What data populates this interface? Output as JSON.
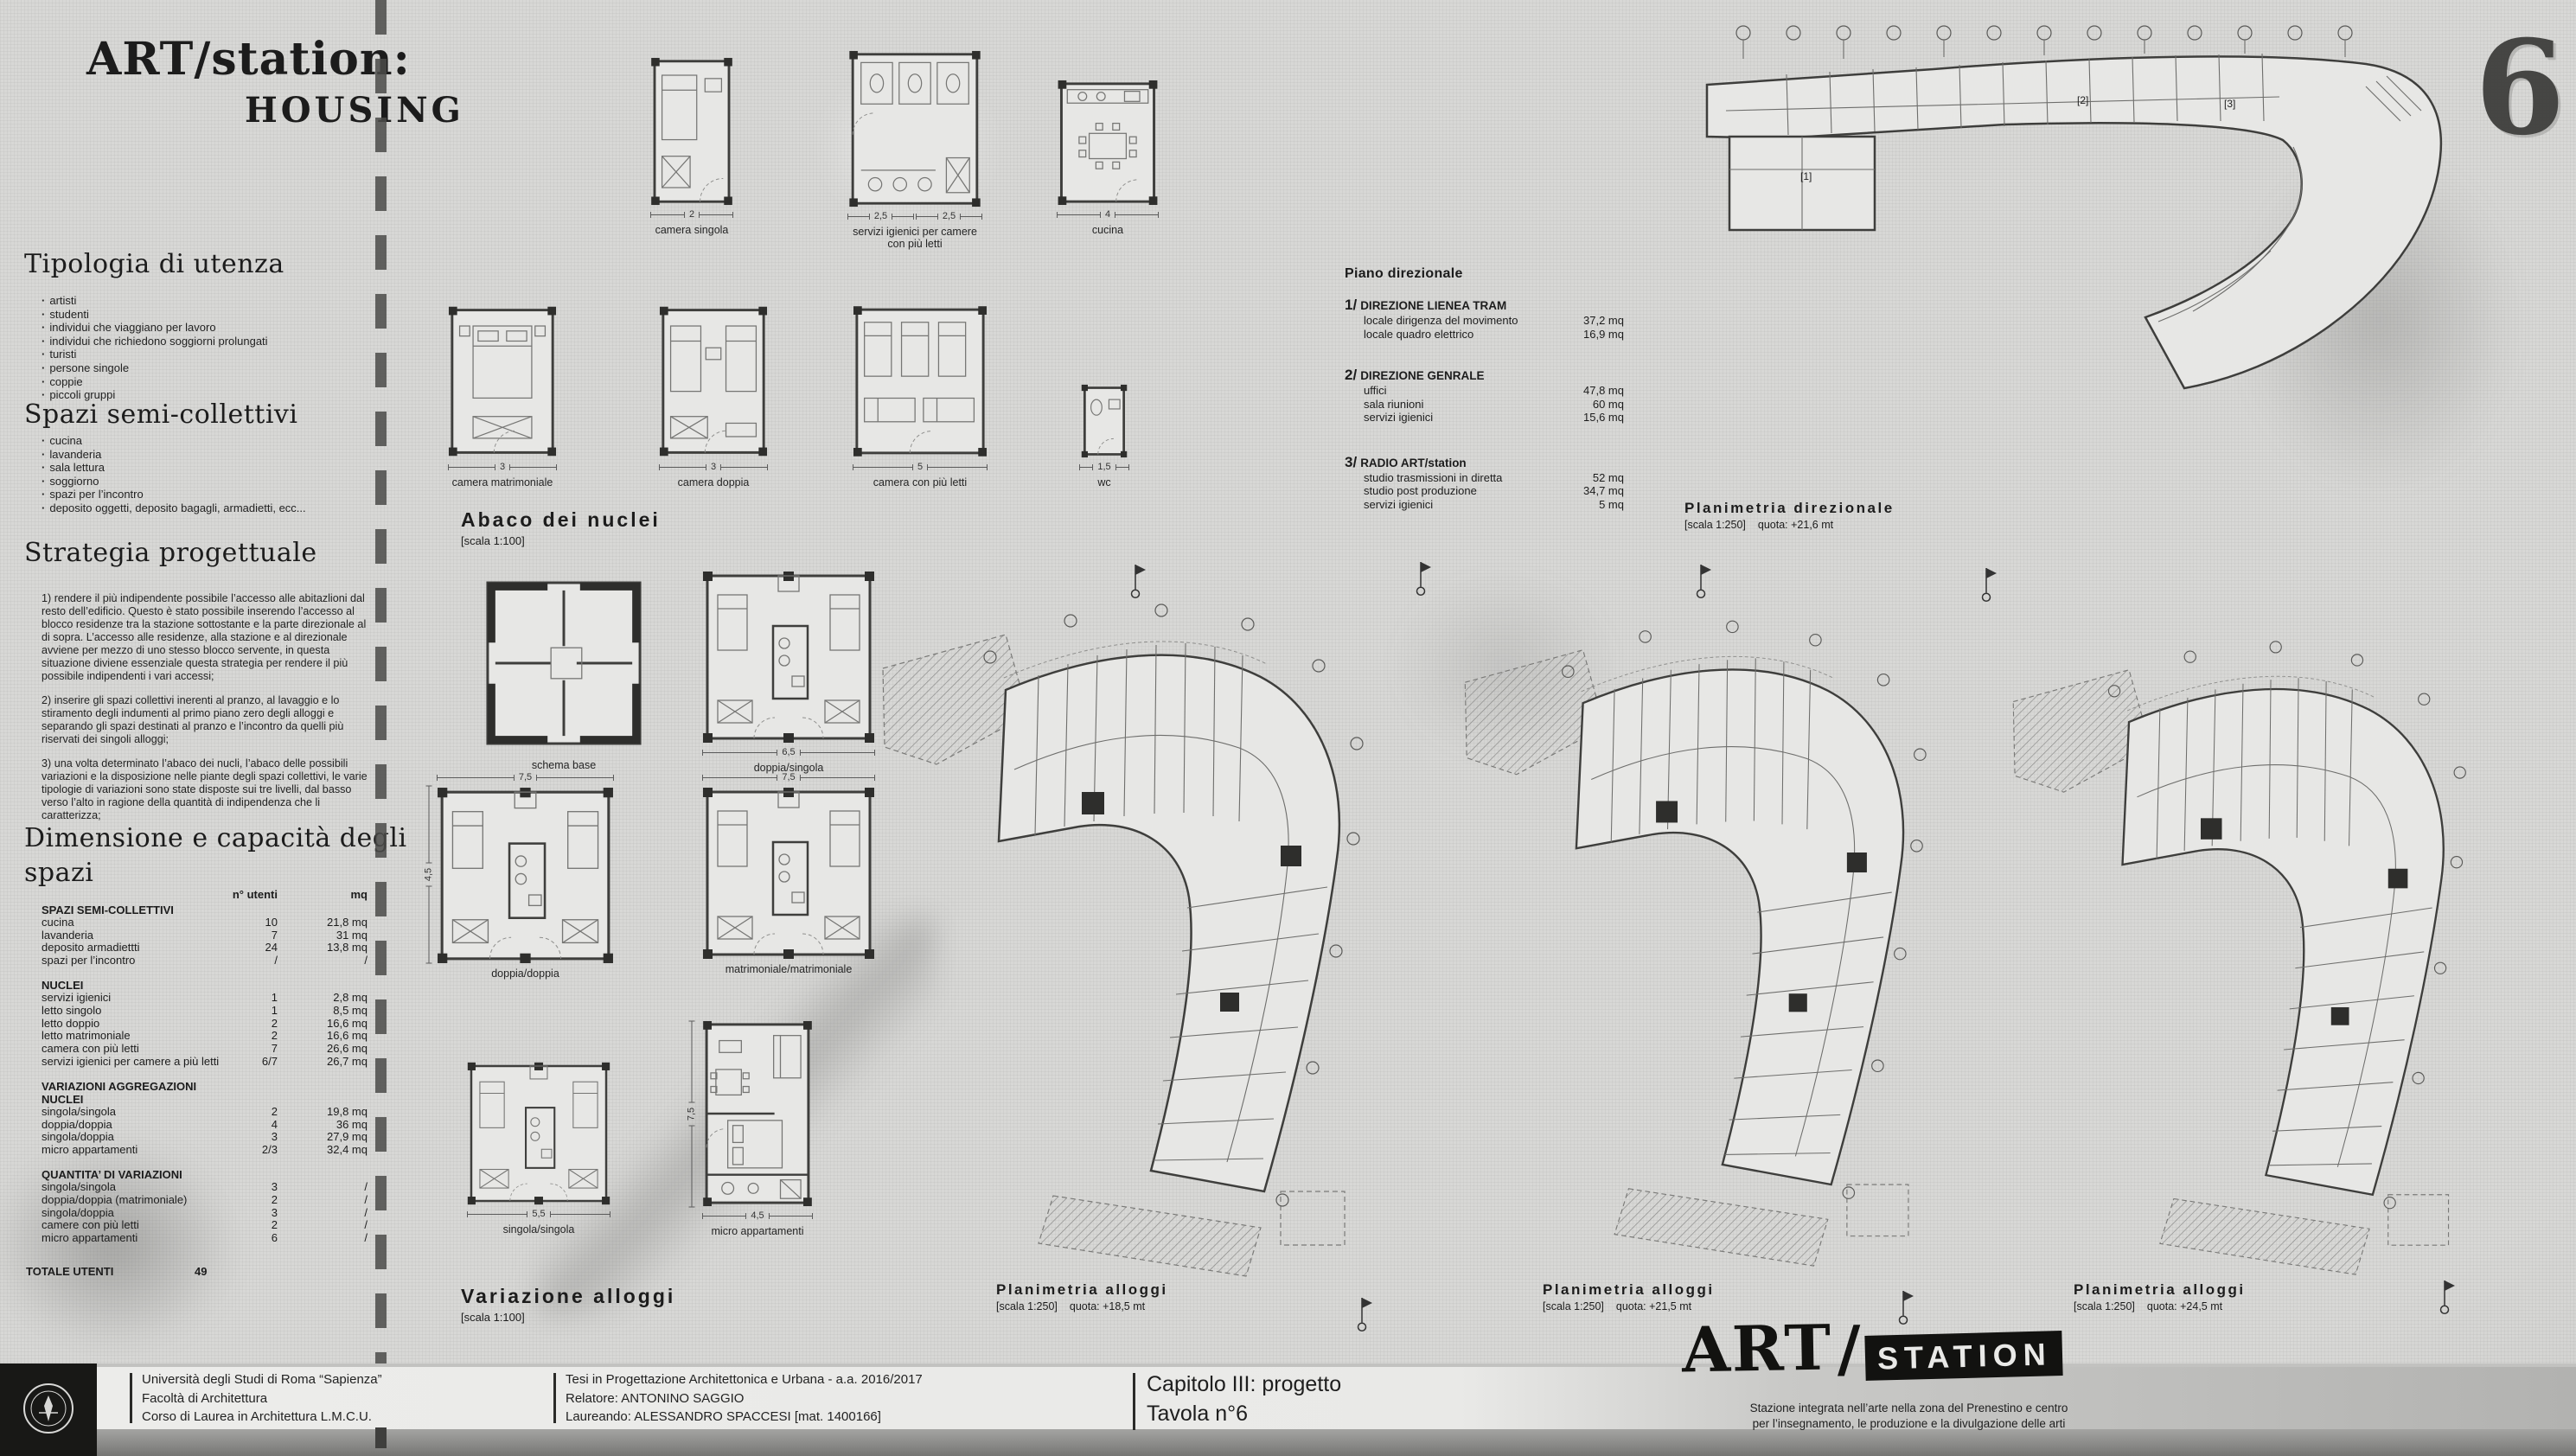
{
  "title": {
    "line1": "ART/station:",
    "line2": "HOUSING"
  },
  "page_number": "6",
  "tipologia": {
    "heading": "Tipologia di utenza",
    "items": [
      "artisti",
      "studenti",
      "individui che viaggiano per lavoro",
      "individui che richiedono soggiorni prolungati",
      "turisti",
      "persone singole",
      "coppie",
      "piccoli gruppi"
    ]
  },
  "spazi": {
    "heading": "Spazi semi-collettivi",
    "items": [
      "cucina",
      "lavanderia",
      "sala lettura",
      "soggiorno",
      "spazi per l’incontro",
      "deposito oggetti, deposito bagagli, armadietti, ecc..."
    ]
  },
  "strategia": {
    "heading": "Strategia progettuale",
    "paragraphs": [
      "1) rendere il più indipendente possibile l’accesso alle abitazlioni dal resto dell’edificio. Questo è stato possibile inserendo l’accesso al blocco residenze tra la stazione sottostante e la parte direzionale al di sopra. L’accesso alle residenze, alla stazione e al direzionale avviene per mezzo di uno stesso blocco servente, in questa situazione diviene essenziale questa strategia per rendere il più possibile indipendenti i vari accessi;",
      "2) inserire gli spazi collettivi inerenti al pranzo, al lavaggio e lo stiramento degli indumenti al primo piano zero degli alloggi e separando gli spazi destinati al pranzo e l’incontro da quelli più riservati dei singoli alloggi;",
      "3) una volta determinato l’abaco dei nucli, l’abaco delle possibili variazioni e la disposizione nelle piante degli spazi collettivi, le varie tipologie di variazioni sono state disposte sui tre livelli, dal basso verso l’alto in ragione della quantità di indipendenza che li caratterizza;"
    ]
  },
  "capacity_table": {
    "heading": "Dimensione e capacità degli spazi",
    "col1": "n° utenti",
    "col2": "mq",
    "groups": [
      {
        "label": "SPAZI SEMI-COLLETTIVI",
        "rows": [
          [
            "cucina",
            "10",
            "21,8 mq"
          ],
          [
            "lavanderia",
            "7",
            "31 mq"
          ],
          [
            "deposito armadiettti",
            "24",
            "13,8 mq"
          ],
          [
            "spazi per l’incontro",
            "/",
            "/"
          ]
        ]
      },
      {
        "label": "NUCLEI",
        "rows": [
          [
            "servizi igienici",
            "1",
            "2,8 mq"
          ],
          [
            "letto singolo",
            "1",
            "8,5 mq"
          ],
          [
            "letto doppio",
            "2",
            "16,6 mq"
          ],
          [
            "letto matrimoniale",
            "2",
            "16,6 mq"
          ],
          [
            "camera con più letti",
            "7",
            "26,6 mq"
          ],
          [
            "servizi igienici per camere a più letti",
            "6/7",
            "26,7 mq"
          ]
        ]
      },
      {
        "label": "VARIAZIONI AGGREGAZIONI NUCLEI",
        "rows": [
          [
            "singola/singola",
            "2",
            "19,8 mq"
          ],
          [
            "doppia/doppia",
            "4",
            "36 mq"
          ],
          [
            "singola/doppia",
            "3",
            "27,9 mq"
          ],
          [
            "micro appartamenti",
            "2/3",
            "32,4 mq"
          ]
        ]
      },
      {
        "label": "QUANTITA’ DI VARIAZIONI",
        "rows": [
          [
            "singola/singola",
            "3",
            "/"
          ],
          [
            "doppia/doppia (matrimoniale)",
            "2",
            "/"
          ],
          [
            "singola/doppia",
            "3",
            "/"
          ],
          [
            "camere con più letti",
            "2",
            "/"
          ],
          [
            "micro appartamenti",
            "6",
            "/"
          ]
        ]
      }
    ],
    "total_label": "TOTALE UTENTI",
    "total_value": "49"
  },
  "piano_direzionale": {
    "heading": "Piano direzionale",
    "groups": [
      {
        "num": "1/",
        "name": "DIREZIONE LIENEA TRAM",
        "rows": [
          [
            "locale dirigenza del movimento",
            "37,2 mq"
          ],
          [
            "locale quadro elettrico",
            "16,9  mq"
          ]
        ]
      },
      {
        "num": "2/",
        "name": "DIREZIONE GENRALE",
        "rows": [
          [
            "uffici",
            "47,8 mq"
          ],
          [
            "sala riunioni",
            "60 mq"
          ],
          [
            "servizi igienici",
            "15,6 mq"
          ]
        ]
      },
      {
        "num": "3/",
        "name": "RADIO ART/station",
        "rows": [
          [
            "studio trasmissioni in diretta",
            "52 mq"
          ],
          [
            "studio post produzione",
            "34,7 mq"
          ],
          [
            "servizi igienici",
            "5 mq"
          ]
        ]
      }
    ]
  },
  "abaco": {
    "heading": "Abaco dei nuclei",
    "scale": "[scala 1:100]",
    "plans": [
      {
        "label": "camera singola",
        "dim": "2"
      },
      {
        "label": "servizi igienici per camere con più letti",
        "dim": "2,5",
        "dim2": "2,5"
      },
      {
        "label": "cucina",
        "dim": "4"
      },
      {
        "label": "camera matrimoniale",
        "dim": "3"
      },
      {
        "label": "camera doppia",
        "dim": "3"
      },
      {
        "label": "camera con più letti",
        "dim": "5"
      },
      {
        "label": "wc",
        "dim": "1,5"
      }
    ]
  },
  "variazione": {
    "heading": "Variazione alloggi",
    "scale": "[scala 1:100]",
    "plans": [
      {
        "label": "schema base"
      },
      {
        "label": "doppia/singola",
        "dim": "6,5"
      },
      {
        "label": "doppia/doppia",
        "dim": "7,5",
        "dim_left": "4,5"
      },
      {
        "label": "matrimoniale/matrimoniale",
        "dim": "7,5"
      },
      {
        "label": "singola/singola",
        "dim": "5,5"
      },
      {
        "label": "micro appartamenti",
        "dim": "4,5",
        "dim_left": "7,5"
      }
    ]
  },
  "planimetrie": [
    {
      "heading": "Planimetria direzionale",
      "scale": "[scala 1:250]",
      "quota": "quota: +21,6 mt"
    },
    {
      "heading": "Planimetria alloggi",
      "scale": "[scala 1:250]",
      "quota": "quota: +18,5 mt"
    },
    {
      "heading": "Planimetria alloggi",
      "scale": "[scala 1:250]",
      "quota": "quota: +21,5 mt"
    },
    {
      "heading": "Planimetria alloggi",
      "scale": "[scala 1:250]",
      "quota": "quota: +24,5 mt"
    }
  ],
  "direzionale_marks": {
    "m1": "[1]",
    "m2": "[2]",
    "m3": "[3]"
  },
  "footer": {
    "university": [
      "Università degli Studi di Roma “Sapienza”",
      "Facoltà di Architettura",
      "Corso di Laurea in Architettura L.M.C.U."
    ],
    "thesis": [
      "Tesi in Progettazione Architettonica e Urbana - a.a. 2016/2017",
      "Relatore: ANTONINO SAGGIO",
      "Laureando: ALESSANDRO SPACCESI [mat. 1400166]"
    ],
    "chapter": [
      "Capitolo III: progetto",
      "Tavola n°6"
    ],
    "logo": {
      "art": "ART",
      "slash": "/",
      "station": "STATION",
      "tagline1": "Stazione integrata nell’arte nella zona del Prenestino e centro",
      "tagline2": "per l’insegnamento, le produzione e la divulgazione delle arti"
    }
  }
}
